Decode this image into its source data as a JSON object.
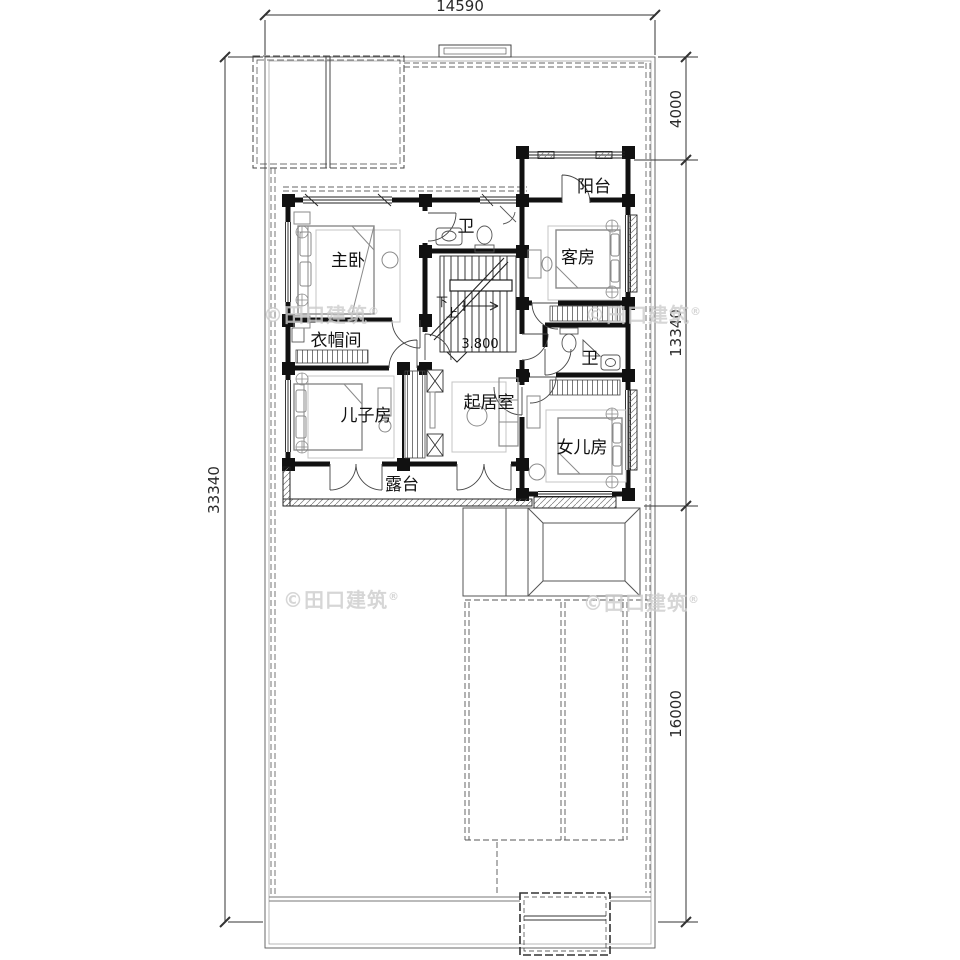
{
  "drawing": {
    "type": "residential floor plan (second floor)",
    "rooms": {
      "yangtai": {
        "label": "阳台"
      },
      "wei1": {
        "label": "卫"
      },
      "zhuwo": {
        "label": "主卧"
      },
      "kefang": {
        "label": "客房"
      },
      "yimaojian": {
        "label": "衣帽间"
      },
      "wei2": {
        "label": "卫"
      },
      "erzifang": {
        "label": "儿子房"
      },
      "qijushi": {
        "label": "起居室"
      },
      "nverfang": {
        "label": "女儿房"
      },
      "lutai": {
        "label": "露台"
      }
    },
    "stairs": {
      "down": "下",
      "up": "上"
    },
    "elevation": {
      "value": "3.800"
    },
    "dimensions": {
      "top": {
        "value": "14590"
      },
      "left": {
        "value": "33340"
      },
      "right": {
        "d1": "4000",
        "d2": "13340",
        "d3": "16000"
      }
    },
    "watermark": {
      "text": "©田口建筑",
      "reg": "®"
    },
    "colors": {
      "ink": "#1a1a1a",
      "wall": "#111111",
      "furniture": "#8a8a8a",
      "carpet": "#bbbbbb",
      "watermark": "#cdcdcd",
      "paper": "#ffffff"
    }
  }
}
